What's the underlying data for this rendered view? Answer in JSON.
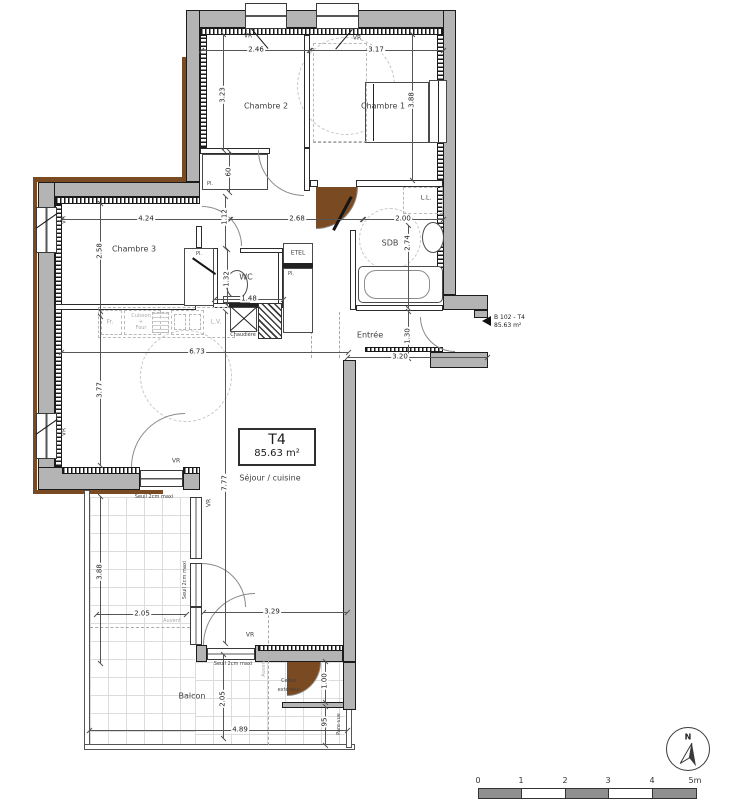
{
  "unit_box": {
    "name": "T4",
    "area": "85.63 m²"
  },
  "entrance_tag": {
    "ref": "B 102 - T4",
    "area": "85.63 m²"
  },
  "rooms": {
    "chambre1": "Chambre 1",
    "chambre2": "Chambre 2",
    "chambre3": "Chambre 3",
    "wc": "WC",
    "sdb": "SDB",
    "etel": "ETEL",
    "entree": "Entrée",
    "sejour": "Séjour / cuisine",
    "balcon": "Balcon",
    "cellier_l1": "Cellier",
    "cellier_l2": "extérieur"
  },
  "labels": {
    "vr": "VR",
    "pl": "Pl.",
    "fr": "Fr.",
    "cuisson_l1": "Cuisson",
    "cuisson_l2": "+",
    "cuisson_l3": "Four",
    "lv": "L.V.",
    "ll": "L.L.",
    "chaudiere": "Chaudière",
    "seuil": "Seuil 2cm maxi",
    "auvent": "Auvent",
    "pare_vue": "Pare-vue"
  },
  "dims": {
    "d246": "2.46",
    "d317": "3.17",
    "d323": "3.23",
    "d388a": "3.88",
    "d60": "60",
    "d424": "4.24",
    "d258": "2.58",
    "d112": "1.12",
    "d268": "2.68",
    "d200": "2.00",
    "d274": "2.74",
    "d132": "1.32",
    "d148": "1.48",
    "d130": "1.30",
    "d320": "3.20",
    "d673": "6.73",
    "d377": "3.77",
    "d777": "7.77",
    "d388b": "3.88",
    "d205a": "2.05",
    "d329": "3.29",
    "d205b": "2.05",
    "d100": "1.00",
    "d95": "95",
    "d489": "4.89"
  },
  "scale_bar": {
    "ticks": [
      "0",
      "1",
      "2",
      "3",
      "4",
      "5m"
    ]
  },
  "compass": {
    "label": "N"
  }
}
